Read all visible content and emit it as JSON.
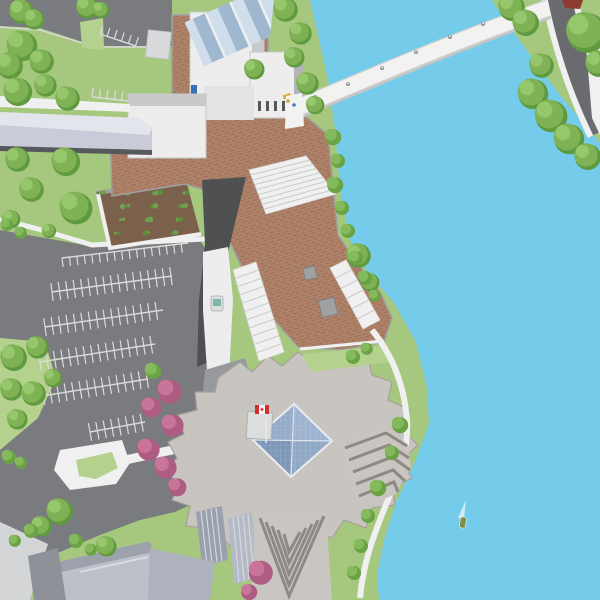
{
  "map": {
    "colors": {
      "water": "#74CBEA",
      "grass": "#A6C77E",
      "grassLight": "#B4D18E",
      "tree": "#7FB254",
      "treeLight": "#97C76C",
      "treeDark": "#5F9A3E",
      "bush": "#85BA5C",
      "bushDark": "#6AA344",
      "road": "#797B7E",
      "roadDark": "#696B6E",
      "parkLine": "#DADBDB",
      "path": "#EFF0EF",
      "pathShade": "#D9DBDA",
      "bldg": "#ECEDEC",
      "bldgShade": "#C7C9CA",
      "bldgGray": "#B2B4B6",
      "brick": "#AE8269",
      "brickLine": "#9C7058",
      "plazaWall": "#9FA1A3",
      "casino": "#C8C4BF",
      "casinoEdge": "#A5A19C",
      "darkRoof": "#4E5052",
      "walkway": "#C9CCD8",
      "walkwayTop": "#E3E5ED",
      "walkwayDark": "#56585C",
      "glassNE": "#9DB3CF",
      "glassSE": "#8FA8C6",
      "glassSW": "#7E97B8",
      "glassNW": "#95ABC8",
      "glassLine": "#D9E2ED",
      "stationGlassL": "#CFDEEA",
      "stationGlassD": "#9FB8CF",
      "bridge": "#F2F3F1",
      "bridgeShadow": "#C3C5C6",
      "rail": "#CFD1D0",
      "slatA": "#9AA0AD",
      "slatB": "#B4BAC6",
      "slatLine": "#D9DBE2",
      "chevLight": "#C9C5C0",
      "chevDark": "#8D8984",
      "soil": "#7B604B",
      "plant": "#6FA14C",
      "pink": "#C9759A",
      "pinkDark": "#AF5C83",
      "flagRed": "#D32F2F",
      "flagWhite": "#F2F2F2",
      "pole": "#E8E8E8",
      "redRoof": "#8F3B34",
      "boat": "#7D8F45",
      "wake": "#DFF3FA",
      "forecourt": "#97999C",
      "cartYellow": "#D4B23C",
      "blueBox": "#3A6FB8",
      "tealRoof": "#7FB5AD",
      "tram": "#DCDEDD"
    },
    "trees": [
      [
        20,
        10,
        12
      ],
      [
        33,
        18,
        10
      ],
      [
        86,
        6,
        11
      ],
      [
        100,
        9,
        8
      ],
      [
        20,
        44,
        15
      ],
      [
        8,
        64,
        13
      ],
      [
        40,
        60,
        12
      ],
      [
        16,
        90,
        14
      ],
      [
        44,
        84,
        11
      ],
      [
        66,
        97,
        12
      ],
      [
        284,
        8,
        12
      ],
      [
        299,
        32,
        11
      ],
      [
        293,
        56,
        10
      ],
      [
        306,
        82,
        11
      ],
      [
        314,
        104,
        9
      ],
      [
        253,
        68,
        10
      ],
      [
        16,
        158,
        12
      ],
      [
        64,
        160,
        14
      ],
      [
        30,
        188,
        12
      ],
      [
        74,
        206,
        16
      ],
      [
        10,
        218,
        9
      ],
      [
        48,
        230,
        7
      ],
      [
        510,
        6,
        13
      ],
      [
        524,
        21,
        13
      ],
      [
        584,
        30,
        20
      ],
      [
        597,
        62,
        13
      ],
      [
        540,
        64,
        12
      ],
      [
        531,
        92,
        15
      ],
      [
        549,
        114,
        16
      ],
      [
        567,
        137,
        15
      ],
      [
        586,
        155,
        13
      ],
      [
        12,
        356,
        13
      ],
      [
        36,
        346,
        11
      ],
      [
        10,
        388,
        11
      ],
      [
        32,
        392,
        12
      ],
      [
        52,
        377,
        9
      ],
      [
        16,
        418,
        10
      ],
      [
        58,
        510,
        13
      ],
      [
        40,
        525,
        10
      ],
      [
        105,
        545,
        10
      ],
      [
        357,
        254,
        12
      ],
      [
        369,
        281,
        9
      ]
    ],
    "bushes": [
      [
        332,
        136,
        8
      ],
      [
        337,
        160,
        7
      ],
      [
        334,
        184,
        8
      ],
      [
        341,
        207,
        7
      ],
      [
        347,
        230,
        7
      ],
      [
        355,
        257,
        7
      ],
      [
        364,
        277,
        7
      ],
      [
        374,
        295,
        6
      ],
      [
        399,
        424,
        8
      ],
      [
        391,
        452,
        7
      ],
      [
        377,
        487,
        8
      ],
      [
        367,
        515,
        7
      ],
      [
        360,
        545,
        7
      ],
      [
        353,
        572,
        7
      ],
      [
        6,
        224,
        6
      ],
      [
        20,
        232,
        6
      ],
      [
        8,
        456,
        7
      ],
      [
        20,
        462,
        6
      ],
      [
        30,
        530,
        7
      ],
      [
        14,
        540,
        6
      ],
      [
        75,
        540,
        7
      ],
      [
        90,
        549,
        6
      ],
      [
        352,
        356,
        7
      ],
      [
        366,
        348,
        6
      ],
      [
        152,
        370,
        8
      ]
    ],
    "pink_trees": [
      [
        168,
        390,
        12
      ],
      [
        150,
        406,
        10
      ],
      [
        171,
        424,
        11
      ],
      [
        147,
        448,
        11
      ],
      [
        164,
        466,
        11
      ],
      [
        176,
        486,
        9
      ],
      [
        259,
        571,
        12
      ],
      [
        248,
        591,
        8
      ]
    ],
    "parking_rows": [
      {
        "x1": 62,
        "y1": 258,
        "x2": 188,
        "y2": 243,
        "sides": "down"
      },
      {
        "x1": 52,
        "y1": 292,
        "x2": 172,
        "y2": 276,
        "sides": "both"
      },
      {
        "x1": 45,
        "y1": 327,
        "x2": 163,
        "y2": 310,
        "sides": "both"
      },
      {
        "x1": 40,
        "y1": 362,
        "x2": 155,
        "y2": 344,
        "sides": "both"
      },
      {
        "x1": 36,
        "y1": 397,
        "x2": 148,
        "y2": 379,
        "sides": "both"
      },
      {
        "x1": 90,
        "y1": 432,
        "x2": 145,
        "y2": 422,
        "sides": "both"
      },
      {
        "x1": 100,
        "y1": 34,
        "x2": 136,
        "y2": 46,
        "sides": "up"
      },
      {
        "x1": 92,
        "y1": 97,
        "x2": 128,
        "y2": 101,
        "sides": "up"
      }
    ],
    "garden": {
      "x1": 98,
      "y1": 193,
      "x2": 186,
      "y2": 180,
      "x3": 200,
      "y3": 233,
      "x4": 110,
      "y4": 247,
      "count": 30
    },
    "stairs": [
      {
        "a": [
          249,
          170
        ],
        "b": [
          306,
          156
        ],
        "c": [
          336,
          194
        ],
        "d": [
          266,
          214
        ],
        "n": 9
      },
      {
        "a": [
          233,
          270
        ],
        "b": [
          256,
          262
        ],
        "c": [
          284,
          352
        ],
        "d": [
          259,
          361
        ],
        "n": 11
      },
      {
        "a": [
          330,
          268
        ],
        "b": [
          346,
          260
        ],
        "c": [
          380,
          320
        ],
        "d": [
          363,
          329
        ],
        "n": 6
      }
    ],
    "chevron_tower": {
      "vx": 289,
      "vy0": 596,
      "dvy": 11,
      "leftx0": 260,
      "rightx0": 324,
      "dx": 6,
      "top": 518,
      "n": 5
    },
    "bridge_lampposts": [
      [
        315,
        97
      ],
      [
        348,
        84
      ],
      [
        382,
        68
      ],
      [
        416,
        52
      ],
      [
        450,
        37
      ],
      [
        483,
        24
      ],
      [
        516,
        12
      ]
    ],
    "plaza_people": [
      [
        288,
        101,
        "#C9A43A"
      ],
      [
        294,
        105,
        "#4A78C0"
      ]
    ],
    "boat": {
      "x": 460,
      "y": 517
    }
  }
}
